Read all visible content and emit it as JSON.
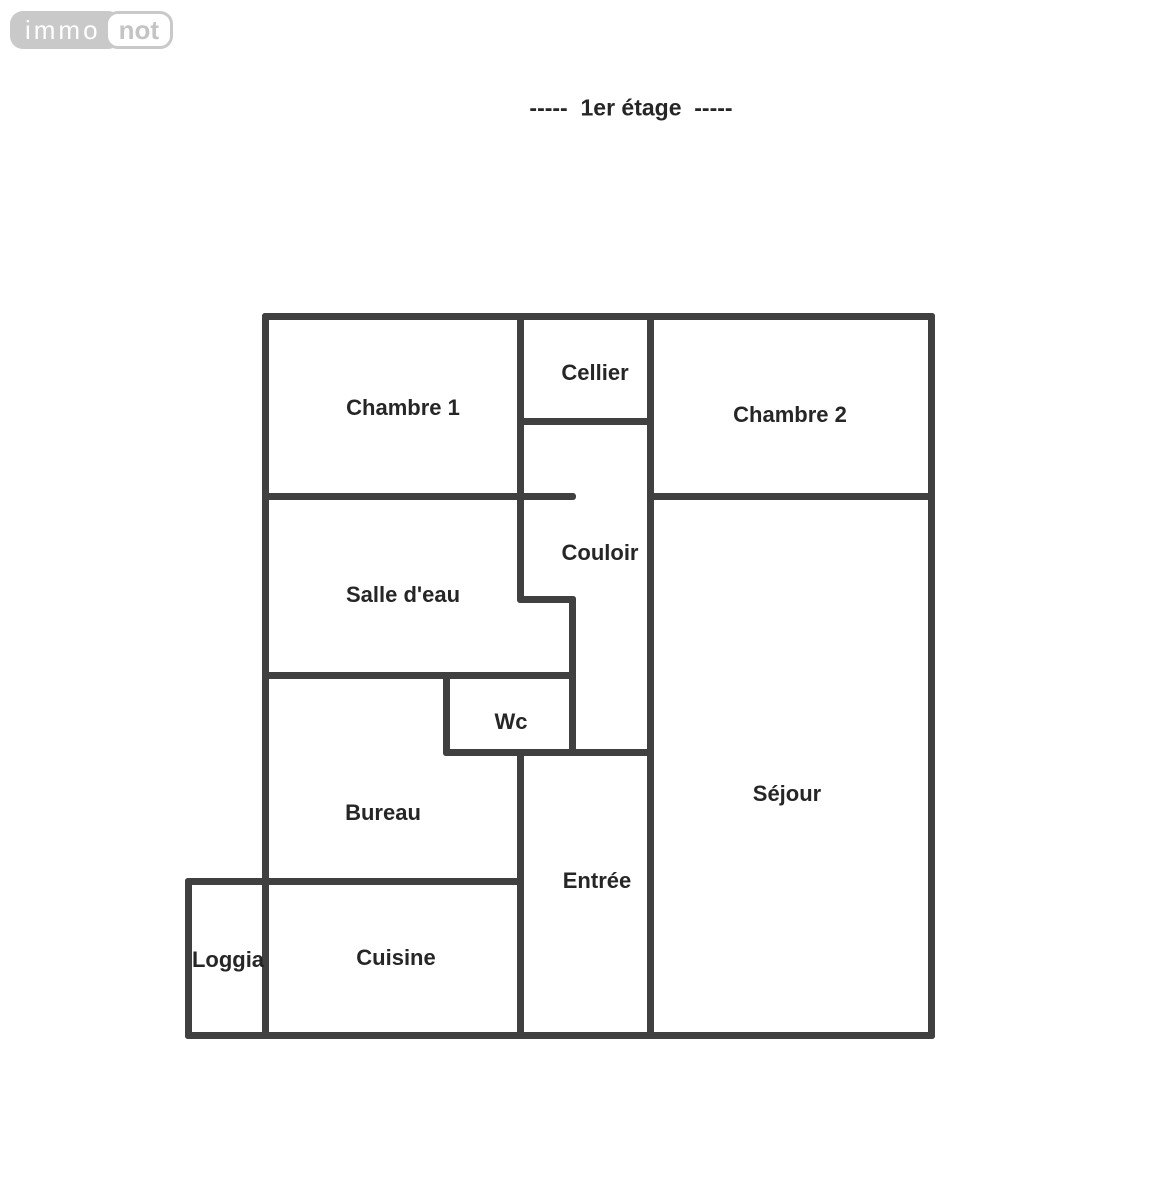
{
  "logo": {
    "immo": "immo",
    "not": "not"
  },
  "title": "-----  1er étage  -----",
  "colors": {
    "wall": "#404040",
    "label": "#262626",
    "logo_gray": "#c9c9c9",
    "background": "#ffffff"
  },
  "floorplan": {
    "wall_thickness": 7,
    "rooms": [
      {
        "name": "Chambre 1",
        "x": 403,
        "y": 408
      },
      {
        "name": "Cellier",
        "x": 595,
        "y": 373
      },
      {
        "name": "Chambre 2",
        "x": 790,
        "y": 415
      },
      {
        "name": "Salle d'eau",
        "x": 403,
        "y": 595
      },
      {
        "name": "Couloir",
        "x": 600,
        "y": 553
      },
      {
        "name": "Wc",
        "x": 511,
        "y": 722
      },
      {
        "name": "Bureau",
        "x": 383,
        "y": 813
      },
      {
        "name": "Séjour",
        "x": 787,
        "y": 794
      },
      {
        "name": "Entrée",
        "x": 597,
        "y": 881
      },
      {
        "name": "Cuisine",
        "x": 396,
        "y": 958
      },
      {
        "name": "Loggia",
        "x": 228,
        "y": 960
      }
    ],
    "walls": [
      {
        "id": "outer-top",
        "o": "h",
        "x": 262,
        "y": 313,
        "len": 673
      },
      {
        "id": "outer-left",
        "o": "v",
        "x": 262,
        "y": 313,
        "len": 726
      },
      {
        "id": "outer-right",
        "o": "v",
        "x": 928,
        "y": 313,
        "len": 726
      },
      {
        "id": "outer-bottom",
        "o": "h",
        "x": 185,
        "y": 1032,
        "len": 750
      },
      {
        "id": "loggia-left",
        "o": "v",
        "x": 185,
        "y": 878,
        "len": 161
      },
      {
        "id": "loggia-top-bureau-bottom",
        "o": "h",
        "x": 185,
        "y": 878,
        "len": 339
      },
      {
        "id": "chambre1-cellier-divider",
        "o": "v",
        "x": 517,
        "y": 313,
        "len": 289
      },
      {
        "id": "cellier-bottom",
        "o": "h",
        "x": 517,
        "y": 418,
        "len": 137
      },
      {
        "id": "cellier-chambre2-divider",
        "o": "v",
        "x": 647,
        "y": 313,
        "len": 726
      },
      {
        "id": "chambre1-bottom",
        "o": "h",
        "x": 262,
        "y": 493,
        "len": 314
      },
      {
        "id": "chambre2-bottom",
        "o": "h",
        "x": 647,
        "y": 493,
        "len": 288
      },
      {
        "id": "couloir-jog",
        "o": "h",
        "x": 517,
        "y": 596,
        "len": 59
      },
      {
        "id": "couloir-west-lower",
        "o": "v",
        "x": 569,
        "y": 596,
        "len": 160
      },
      {
        "id": "salle-deau-bottom",
        "o": "h",
        "x": 262,
        "y": 672,
        "len": 314
      },
      {
        "id": "wc-left",
        "o": "v",
        "x": 443,
        "y": 672,
        "len": 84
      },
      {
        "id": "wc-entree-top",
        "o": "h",
        "x": 443,
        "y": 749,
        "len": 211
      },
      {
        "id": "bureau-entree-divider",
        "o": "v",
        "x": 517,
        "y": 749,
        "len": 290
      }
    ]
  }
}
